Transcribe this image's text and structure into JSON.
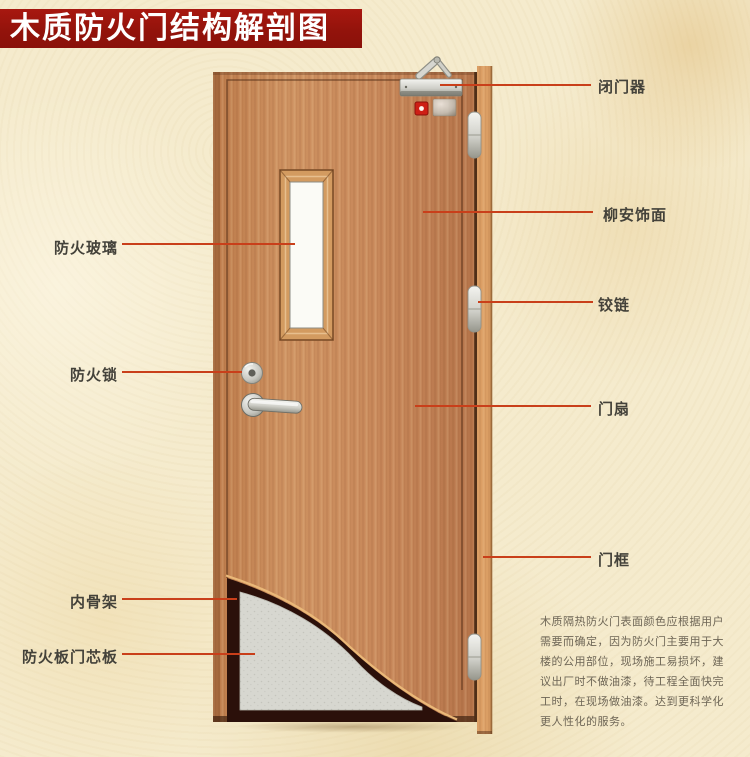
{
  "title": {
    "text": "木质防火门结构解剖图"
  },
  "labels": {
    "left": [
      {
        "id": "fireproof-glass",
        "text": "防火玻璃"
      },
      {
        "id": "fireproof-lock",
        "text": "防火锁"
      },
      {
        "id": "inner-skeleton",
        "text": "内骨架"
      },
      {
        "id": "fire-board-core",
        "text": "防火板门芯板"
      }
    ],
    "right": [
      {
        "id": "door-closer",
        "text": "闭门器"
      },
      {
        "id": "lauan-veneer",
        "text": "柳安饰面"
      },
      {
        "id": "hinge",
        "text": "铰链"
      },
      {
        "id": "door-leaf",
        "text": "门扇"
      },
      {
        "id": "door-frame",
        "text": "门框"
      }
    ]
  },
  "side_note": {
    "lines": [
      "木质隔热防火门表面颜色应根据用户",
      "需要而确定，因为防火门主要用于大",
      "楼的公用部位，现场施工易损坏，建",
      "议出厂时不做油漆，待工程全面快完",
      "工时，在现场做油漆。达到更科学化",
      "更人性化的服务。"
    ]
  },
  "colors": {
    "banner": "#93130b",
    "leader_line": "#c93f1a",
    "background": "#f5ebcd",
    "door_wood": "#c8875a",
    "frame_wood": "#db9e64",
    "core_panel": "#d7d7d0",
    "skeleton_dark": "#2b100a",
    "glass": "#fbfbf6"
  }
}
